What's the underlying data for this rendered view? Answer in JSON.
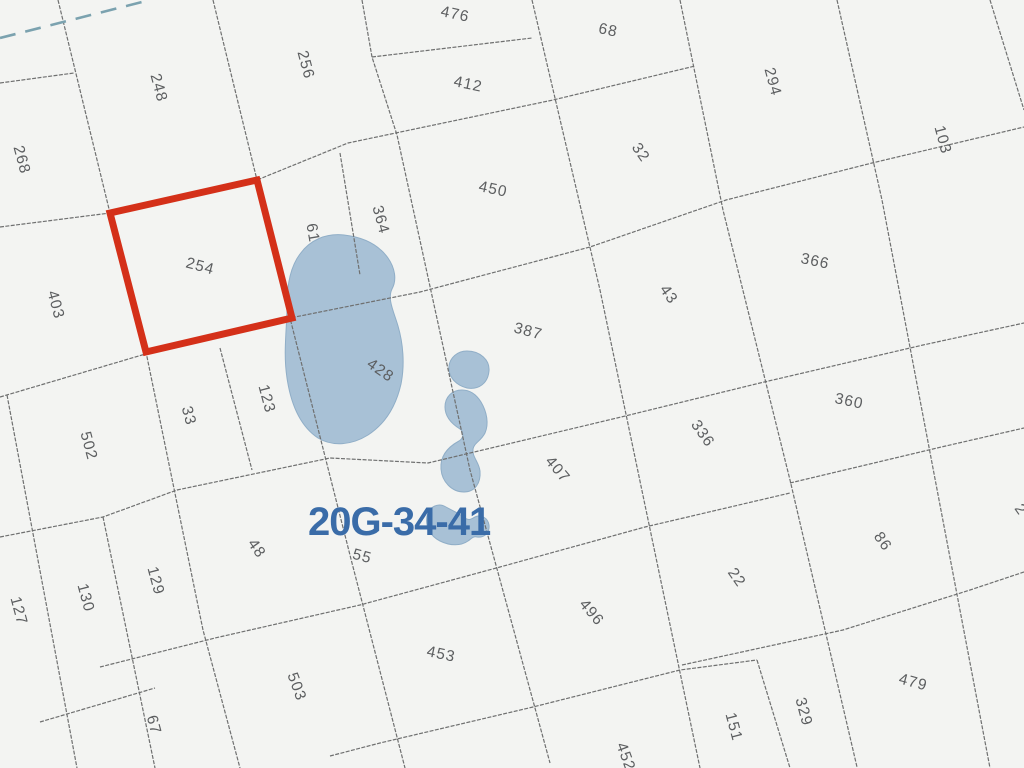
{
  "map": {
    "region_label": "20G-34-41",
    "background": "#f3f4f2",
    "colors": {
      "boundary": "#6f7070",
      "water_fill": "#a8c1d6",
      "water_edge": "#90aec7",
      "highlight": "#d43019",
      "parcel_text": "#5c5e60",
      "region_text": "#3a6ca8",
      "waterline": "#7ba2af"
    },
    "highlight_parcel": {
      "label": "254",
      "points": [
        [
          110,
          213
        ],
        [
          257,
          180
        ],
        [
          292,
          318
        ],
        [
          146,
          352
        ]
      ]
    },
    "parcel_labels": [
      {
        "text": "248",
        "x": 158,
        "y": 88,
        "rot": 75
      },
      {
        "text": "256",
        "x": 305,
        "y": 65,
        "rot": 75
      },
      {
        "text": "268",
        "x": 21,
        "y": 160,
        "rot": 75
      },
      {
        "text": "476",
        "x": 455,
        "y": 15,
        "rot": 12
      },
      {
        "text": "68",
        "x": 608,
        "y": 31,
        "rot": 12
      },
      {
        "text": "412",
        "x": 468,
        "y": 85,
        "rot": 12
      },
      {
        "text": "294",
        "x": 772,
        "y": 82,
        "rot": 75
      },
      {
        "text": "103",
        "x": 942,
        "y": 140,
        "rot": 75
      },
      {
        "text": "450",
        "x": 493,
        "y": 190,
        "rot": 12
      },
      {
        "text": "32",
        "x": 640,
        "y": 153,
        "rot": 55
      },
      {
        "text": "364",
        "x": 380,
        "y": 220,
        "rot": 75
      },
      {
        "text": "61",
        "x": 312,
        "y": 233,
        "rot": 80
      },
      {
        "text": "254",
        "x": 200,
        "y": 267,
        "rot": 15
      },
      {
        "text": "403",
        "x": 55,
        "y": 305,
        "rot": 75
      },
      {
        "text": "43",
        "x": 668,
        "y": 295,
        "rot": 55
      },
      {
        "text": "366",
        "x": 815,
        "y": 262,
        "rot": 12
      },
      {
        "text": "387",
        "x": 528,
        "y": 332,
        "rot": 15
      },
      {
        "text": "428",
        "x": 380,
        "y": 371,
        "rot": 35
      },
      {
        "text": "123",
        "x": 266,
        "y": 399,
        "rot": 75
      },
      {
        "text": "33",
        "x": 188,
        "y": 416,
        "rot": 75
      },
      {
        "text": "502",
        "x": 88,
        "y": 446,
        "rot": 75
      },
      {
        "text": "336",
        "x": 702,
        "y": 434,
        "rot": 55
      },
      {
        "text": "360",
        "x": 849,
        "y": 402,
        "rot": 12
      },
      {
        "text": "407",
        "x": 557,
        "y": 470,
        "rot": 50
      },
      {
        "text": "55",
        "x": 362,
        "y": 557,
        "rot": 15
      },
      {
        "text": "48",
        "x": 256,
        "y": 549,
        "rot": 55
      },
      {
        "text": "129",
        "x": 155,
        "y": 581,
        "rot": 75
      },
      {
        "text": "130",
        "x": 85,
        "y": 598,
        "rot": 75
      },
      {
        "text": "127",
        "x": 18,
        "y": 611,
        "rot": 75
      },
      {
        "text": "67",
        "x": 153,
        "y": 725,
        "rot": 75
      },
      {
        "text": "503",
        "x": 296,
        "y": 687,
        "rot": 70
      },
      {
        "text": "453",
        "x": 441,
        "y": 655,
        "rot": 12
      },
      {
        "text": "496",
        "x": 591,
        "y": 613,
        "rot": 50
      },
      {
        "text": "22",
        "x": 736,
        "y": 578,
        "rot": 55
      },
      {
        "text": "151",
        "x": 733,
        "y": 727,
        "rot": 75
      },
      {
        "text": "329",
        "x": 803,
        "y": 712,
        "rot": 75
      },
      {
        "text": "86",
        "x": 882,
        "y": 542,
        "rot": 55
      },
      {
        "text": "479",
        "x": 913,
        "y": 683,
        "rot": 15
      },
      {
        "text": "452",
        "x": 625,
        "y": 757,
        "rot": 70
      },
      {
        "text": "2",
        "x": 1020,
        "y": 510,
        "rot": 55
      }
    ],
    "boundaries": [
      {
        "points": [
          [
            58,
            0
          ],
          [
            110,
            213
          ],
          [
            146,
            352
          ],
          [
            203,
            630
          ],
          [
            240,
            768
          ]
        ]
      },
      {
        "points": [
          [
            213,
            0
          ],
          [
            257,
            180
          ],
          [
            290,
            318
          ],
          [
            352,
            563
          ],
          [
            405,
            768
          ]
        ]
      },
      {
        "points": [
          [
            340,
            153
          ],
          [
            360,
            275
          ]
        ]
      },
      {
        "points": [
          [
            362,
            0
          ],
          [
            372,
            57
          ],
          [
            397,
            135
          ],
          [
            470,
            470
          ],
          [
            550,
            763
          ]
        ]
      },
      {
        "points": [
          [
            532,
            0
          ],
          [
            600,
            290
          ],
          [
            700,
            768
          ]
        ]
      },
      {
        "points": [
          [
            680,
            0
          ],
          [
            723,
            210
          ],
          [
            790,
            480
          ],
          [
            857,
            767
          ]
        ]
      },
      {
        "points": [
          [
            837,
            0
          ],
          [
            882,
            200
          ],
          [
            990,
            768
          ]
        ]
      },
      {
        "points": [
          [
            990,
            0
          ],
          [
            1024,
            110
          ]
        ]
      },
      {
        "points": [
          [
            7,
            395
          ],
          [
            77,
            768
          ]
        ]
      },
      {
        "points": [
          [
            103,
            517
          ],
          [
            155,
            768
          ]
        ]
      },
      {
        "points": [
          [
            220,
            348
          ],
          [
            252,
            470
          ]
        ]
      },
      {
        "points": [
          [
            757,
            660
          ],
          [
            790,
            768
          ]
        ]
      },
      {
        "points": [
          [
            0,
            83
          ],
          [
            74,
            73
          ]
        ]
      },
      {
        "points": [
          [
            0,
            227
          ],
          [
            110,
            213
          ]
        ]
      },
      {
        "points": [
          [
            110,
            213
          ],
          [
            257,
            180
          ],
          [
            348,
            143
          ],
          [
            553,
            100
          ],
          [
            695,
            66
          ]
        ]
      },
      {
        "points": [
          [
            372,
            57
          ],
          [
            532,
            38
          ]
        ]
      },
      {
        "points": [
          [
            0,
            397
          ],
          [
            142,
            355
          ],
          [
            290,
            318
          ],
          [
            420,
            292
          ],
          [
            590,
            247
          ],
          [
            726,
            200
          ],
          [
            872,
            163
          ],
          [
            1024,
            127
          ]
        ]
      },
      {
        "points": [
          [
            0,
            537
          ],
          [
            103,
            517
          ],
          [
            177,
            490
          ],
          [
            330,
            458
          ],
          [
            428,
            463
          ],
          [
            617,
            418
          ],
          [
            760,
            383
          ],
          [
            923,
            345
          ],
          [
            1024,
            323
          ]
        ]
      },
      {
        "points": [
          [
            790,
            483
          ],
          [
            937,
            448
          ],
          [
            1024,
            428
          ]
        ]
      },
      {
        "points": [
          [
            100,
            667
          ],
          [
            215,
            638
          ],
          [
            360,
            605
          ],
          [
            500,
            567
          ],
          [
            645,
            527
          ],
          [
            790,
            493
          ]
        ]
      },
      {
        "points": [
          [
            682,
            665
          ],
          [
            843,
            630
          ],
          [
            970,
            590
          ],
          [
            1024,
            572
          ]
        ]
      },
      {
        "points": [
          [
            330,
            756
          ],
          [
            380,
            743
          ],
          [
            533,
            707
          ],
          [
            680,
            670
          ],
          [
            757,
            660
          ]
        ]
      },
      {
        "points": [
          [
            40,
            722
          ],
          [
            155,
            688
          ]
        ]
      }
    ],
    "water_line": {
      "points": [
        [
          0,
          38
        ],
        [
          150,
          0
        ]
      ]
    },
    "lakes": [
      {
        "path": "M344,235 C326,233 310,240 300,254 C291,266 287,284 287,305 C287,330 283,352 287,378 C291,405 300,426 318,438 C333,447 352,445 368,435 C385,424 396,406 401,384 C405,364 403,343 398,326 C394,312 387,299 392,289 C397,280 395,268 388,258 C378,244 362,237 344,235 Z"
      },
      {
        "path": "M467,351 C457,351 450,358 449,366 C448,376 455,385 467,388 C479,390 488,383 489,371 C490,360 480,351 467,351 Z"
      },
      {
        "path": "M462,390 C452,390 445,397 445,407 C445,417 452,424 460,429 C464,432 464,438 459,441 C448,447 440,456 441,469 C442,482 452,492 464,492 C475,492 481,483 480,471 C479,462 472,457 473,449 C474,443 481,441 485,433 C489,424 487,412 481,402 C476,394 470,390 462,390 Z"
      },
      {
        "path": "M446,507 C438,502 429,507 427,516 C425,526 430,536 440,541 C450,546 461,546 468,541 C471,539 473,536 477,537 C484,538 490,533 489,525 C488,518 481,514 475,517 C471,519 469,521 465,518 C459,513 453,511 446,507 Z"
      }
    ]
  }
}
